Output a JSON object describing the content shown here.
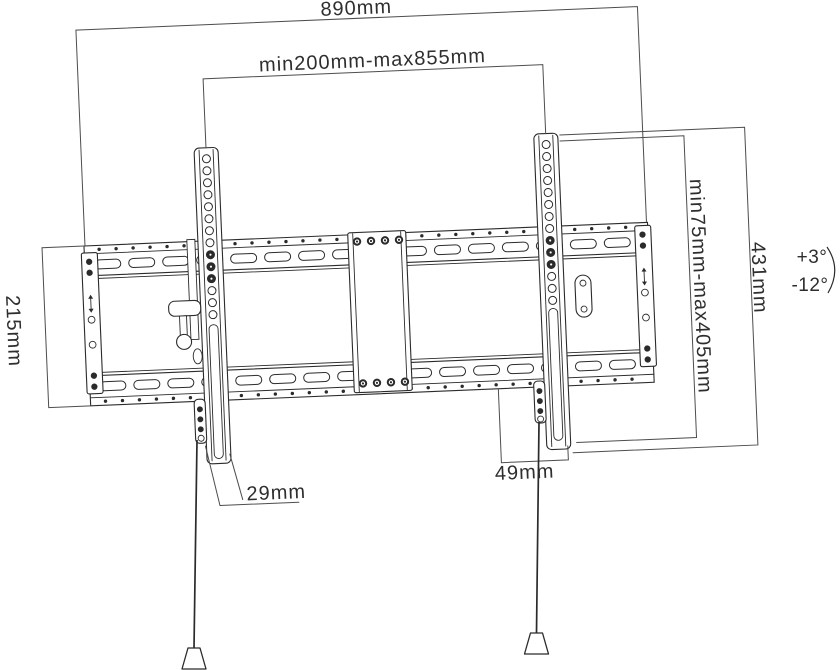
{
  "dimensions": {
    "overall_width": "890mm",
    "mount_span_range": "min200mm-max855mm",
    "bracket_height": "431mm",
    "vesa_height_range": "min75mm-max405mm",
    "wall_plate_height": "215mm",
    "bottom_offset": "29mm",
    "side_offset": "49mm"
  },
  "tilt": {
    "up": "+3°",
    "down": "-12°"
  },
  "colors": {
    "outline": "#2b2b2b",
    "dimension_line": "#4d4d4d",
    "text": "#2e2e2e",
    "background": "#ffffff"
  }
}
